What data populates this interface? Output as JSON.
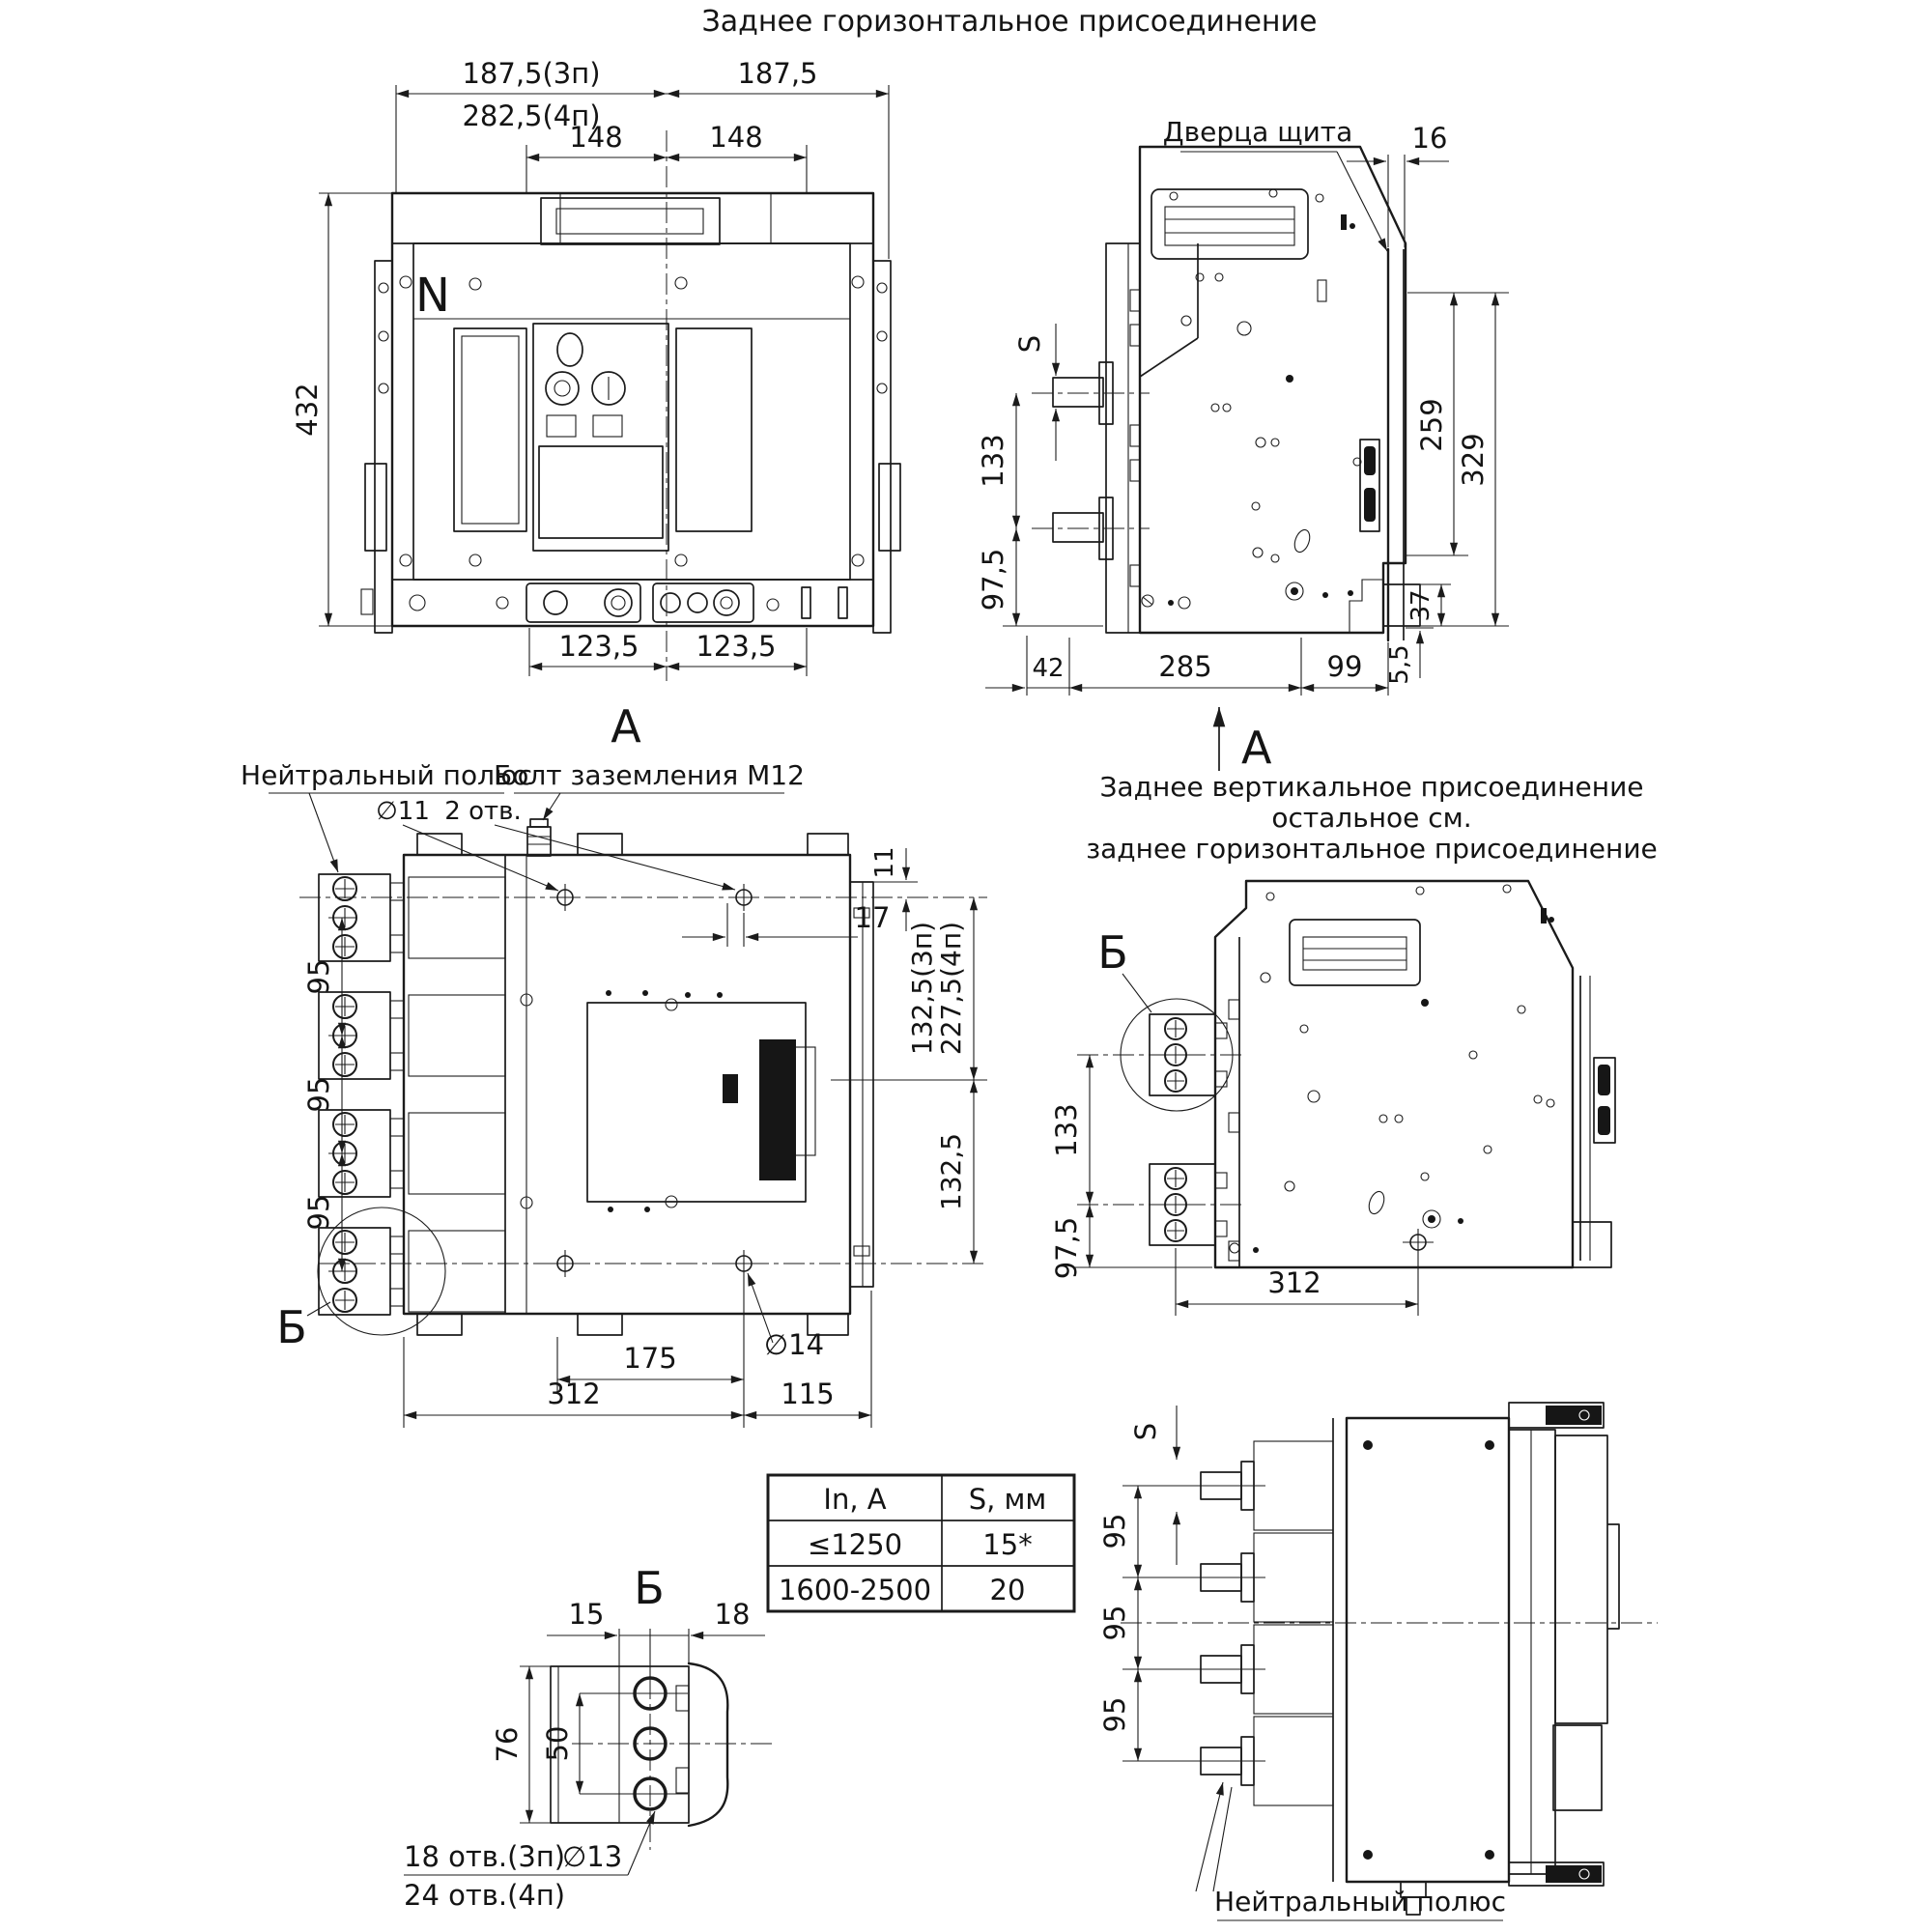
{
  "title": "Заднее горизонтальное присоединение",
  "front_view": {
    "section_label": "А",
    "pole_marking": "N",
    "dim_187_3p": "187,5(3п)",
    "dim_282_4p": "282,5(4п)",
    "dim_187": "187,5",
    "dim_148_left": "148",
    "dim_148_right": "148",
    "dim_432": "432",
    "dim_123_left": "123,5",
    "dim_123_right": "123,5"
  },
  "side_view": {
    "door_label": "Дверца щита",
    "section_label": "А",
    "dim_16": "16",
    "dim_S": "S",
    "dim_133": "133",
    "dim_97": "97,5",
    "dim_259": "259",
    "dim_329": "329",
    "dim_37": "37",
    "dim_5_5": "5,5",
    "dim_42": "42",
    "dim_285": "285",
    "dim_99": "99"
  },
  "top_view": {
    "neutral_label": "Нейтральный полюс",
    "ground_bolt_label": "Болт заземления М12",
    "detail_label": "Б",
    "dim_d11": "∅11",
    "dim_2_holes": "2 отв.",
    "dim_11": "11",
    "dim_17": "17",
    "dim_132_3p": "132,5(3п)",
    "dim_227_4p": "227,5(4п)",
    "dim_132": "132,5",
    "dim_95_1": "95",
    "dim_95_2": "95",
    "dim_95_3": "95",
    "dim_175": "175",
    "dim_312": "312",
    "dim_115": "115",
    "dim_d14": "∅14"
  },
  "vertical_view": {
    "title_line1": "Заднее вертикальное присоединение",
    "title_line2": "остальное см.",
    "title_line3": "заднее горизонтальное присоединение",
    "detail_label": "Б",
    "dim_133": "133",
    "dim_97": "97,5",
    "dim_312": "312"
  },
  "bottom_view": {
    "neutral_label": "Нейтральный полюс",
    "dim_S": "S",
    "dim_95_1": "95",
    "dim_95_2": "95",
    "dim_95_3": "95"
  },
  "detail_b": {
    "label": "Б",
    "dim_15": "15",
    "dim_18": "18",
    "dim_76": "76",
    "dim_50": "50",
    "holes_note_3p": "18 отв.(3п)",
    "holes_note_d13": "∅13",
    "holes_note_4p": "24 отв.(4п)"
  },
  "table": {
    "header_col1": "In, A",
    "header_col2": "S, мм",
    "rows": [
      {
        "in": "≤1250",
        "s": "15*"
      },
      {
        "in": "1600-2500",
        "s": "20"
      }
    ]
  }
}
